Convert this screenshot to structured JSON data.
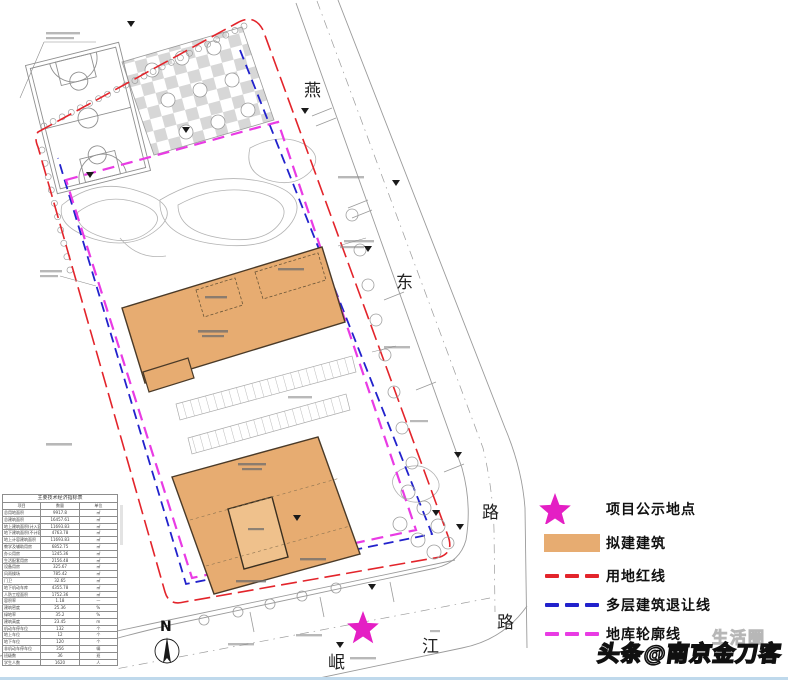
{
  "map": {
    "compass_label": "N",
    "street_chars": {
      "yan": "燕",
      "dong": "东",
      "lu_east": "路",
      "lu_south": "路",
      "jiang": "江",
      "min": "岷"
    },
    "street_names": [
      "燕东路",
      "岷江路"
    ]
  },
  "legend": {
    "items": [
      {
        "icon": "star",
        "label": "项目公示地点",
        "color": "#E41FC4"
      },
      {
        "icon": "building-swatch",
        "label": "拟建建筑",
        "color": "#E7AC71"
      },
      {
        "icon": "red-dash",
        "label": "用地红线",
        "color": "#E3242B"
      },
      {
        "icon": "blue-dash",
        "label": "多层建筑退让线",
        "color": "#2222CC"
      },
      {
        "icon": "magenta-dash",
        "label": "地库轮廓线",
        "color": "#E93BE4"
      }
    ]
  },
  "table": {
    "title": "主要技术经济指标表",
    "headers": [
      "项目",
      "数量",
      "单位"
    ],
    "rows": [
      [
        "总用地面积",
        "9917.8",
        "㎡"
      ],
      [
        "总建筑面积",
        "16457.61",
        "㎡"
      ],
      [
        "地上建筑面积(计入容积率)",
        "11693.83",
        "㎡"
      ],
      [
        "地下建筑面积(不计容积率)",
        "4763.78",
        "㎡"
      ],
      [
        "地上计容建筑面积",
        "11693.83",
        "㎡"
      ],
      [
        "教学及辅助用房",
        "6852.75",
        "㎡"
      ],
      [
        "办公用房",
        "1245.36",
        "㎡"
      ],
      [
        "生活配套用房",
        "2156.48",
        "㎡"
      ],
      [
        "设备用房",
        "325.67",
        "㎡"
      ],
      [
        "风雨操场",
        "785.42",
        "㎡"
      ],
      [
        "门卫",
        "32.65",
        "㎡"
      ],
      [
        "地下机动车库",
        "4355.78",
        "㎡"
      ],
      [
        "人防工程面积",
        "1752.36",
        "㎡"
      ],
      [
        "容积率",
        "1.18",
        "—"
      ],
      [
        "建筑密度",
        "25.36",
        "%"
      ],
      [
        "绿地率",
        "35.2",
        "%"
      ],
      [
        "建筑高度",
        "23.45",
        "m"
      ],
      [
        "机动车停车位",
        "132",
        "个"
      ],
      [
        "地上车位",
        "12",
        "个"
      ],
      [
        "地下车位",
        "120",
        "个"
      ],
      [
        "非机动车停车位",
        "356",
        "辆"
      ],
      [
        "班级数",
        "36",
        "班"
      ],
      [
        "学生人数",
        "1620",
        "人"
      ]
    ]
  },
  "watermark": {
    "main": "头条@南京金刀客",
    "ghost": "生活圈"
  },
  "colors": {
    "red_line": "#E3242B",
    "blue_line": "#2222CC",
    "magenta_line": "#E93BE4",
    "building_fill": "#E7AC71",
    "star": "#E41FC4",
    "bottom_bar": "#BFD9EC"
  }
}
